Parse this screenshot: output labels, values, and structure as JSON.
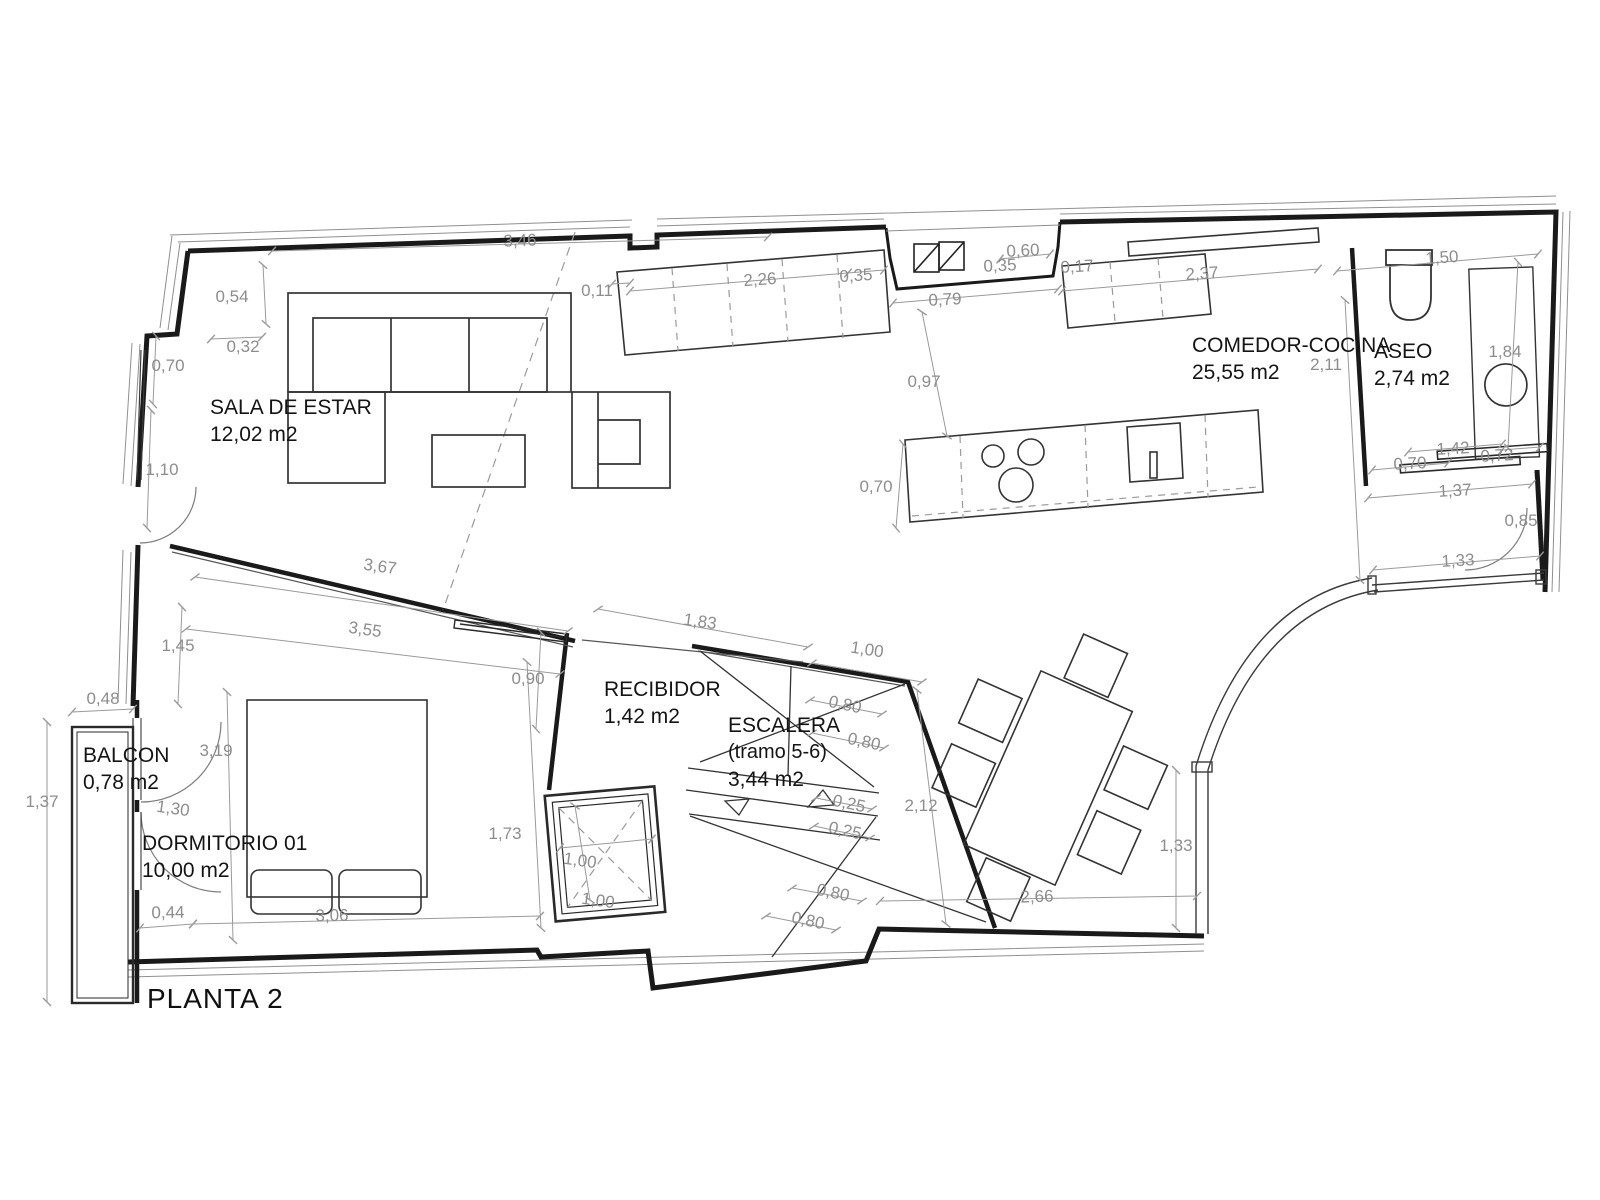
{
  "title": "PLANTA 2",
  "rooms": [
    {
      "id": "sala-de-estar",
      "name": "SALA DE ESTAR",
      "area": "12,02 m2",
      "x": 210,
      "y": 394
    },
    {
      "id": "comedor-cocina",
      "name": "COMEDOR-COCINA",
      "area": "25,55 m2",
      "x": 1192,
      "y": 332
    },
    {
      "id": "aseo",
      "name": "ASEO",
      "area": "2,74 m2",
      "x": 1374,
      "y": 338
    },
    {
      "id": "balcon",
      "name": "BALCON",
      "area": "0,78 m2",
      "x": 83,
      "y": 742
    },
    {
      "id": "dormitorio-01",
      "name": "DORMITORIO 01",
      "area": "10,00 m2",
      "x": 142,
      "y": 830
    },
    {
      "id": "recibidor",
      "name": "RECIBIDOR",
      "area": "1,42 m2",
      "x": 604,
      "y": 676
    },
    {
      "id": "escalera",
      "name": "ESCALERA",
      "sub": "(tramo 5-6)",
      "area": "3,44 m2",
      "x": 728,
      "y": 712
    }
  ],
  "dimensions": [
    {
      "v": "3,46",
      "x": 520,
      "y": 241,
      "r": -2
    },
    {
      "v": "0,54",
      "x": 232,
      "y": 297,
      "r": 0
    },
    {
      "v": "0,32",
      "x": 243,
      "y": 347,
      "r": 0
    },
    {
      "v": "0,70",
      "x": 168,
      "y": 366,
      "r": 0
    },
    {
      "v": "1,10",
      "x": 162,
      "y": 470,
      "r": 0
    },
    {
      "v": "0,11",
      "x": 597,
      "y": 291,
      "r": 0
    },
    {
      "v": "2,26",
      "x": 760,
      "y": 280,
      "r": -4
    },
    {
      "v": "0,35",
      "x": 856,
      "y": 276,
      "r": -4
    },
    {
      "v": "0,79",
      "x": 945,
      "y": 300,
      "r": -3
    },
    {
      "v": "0,60",
      "x": 1023,
      "y": 251,
      "r": -3
    },
    {
      "v": "0,35",
      "x": 1000,
      "y": 266,
      "r": -3
    },
    {
      "v": "0,17",
      "x": 1077,
      "y": 267,
      "r": -3
    },
    {
      "v": "2,37",
      "x": 1202,
      "y": 274,
      "r": -4
    },
    {
      "v": "1,50",
      "x": 1442,
      "y": 258,
      "r": -4
    },
    {
      "v": "0,97",
      "x": 924,
      "y": 382,
      "r": 0
    },
    {
      "v": "2,11",
      "x": 1326,
      "y": 365,
      "r": 0
    },
    {
      "v": "1,84",
      "x": 1505,
      "y": 352,
      "r": 0
    },
    {
      "v": "0,70",
      "x": 876,
      "y": 487,
      "r": 0
    },
    {
      "v": "1,42",
      "x": 1453,
      "y": 449,
      "r": -3
    },
    {
      "v": "0,72",
      "x": 1497,
      "y": 456,
      "r": -3
    },
    {
      "v": "0,70",
      "x": 1410,
      "y": 464,
      "r": -3
    },
    {
      "v": "1,37",
      "x": 1455,
      "y": 491,
      "r": -3
    },
    {
      "v": "0,85",
      "x": 1521,
      "y": 521,
      "r": 0
    },
    {
      "v": "1,33",
      "x": 1458,
      "y": 561,
      "r": -3
    },
    {
      "v": "3,67",
      "x": 380,
      "y": 567,
      "r": 8
    },
    {
      "v": "3,55",
      "x": 365,
      "y": 630,
      "r": 8
    },
    {
      "v": "1,45",
      "x": 178,
      "y": 646,
      "r": 0
    },
    {
      "v": "0,90",
      "x": 528,
      "y": 679,
      "r": 0
    },
    {
      "v": "1,83",
      "x": 700,
      "y": 622,
      "r": 8
    },
    {
      "v": "1,00",
      "x": 867,
      "y": 650,
      "r": 9
    },
    {
      "v": "0,48",
      "x": 103,
      "y": 699,
      "r": 0
    },
    {
      "v": "3,19",
      "x": 216,
      "y": 751,
      "r": 0
    },
    {
      "v": "0,80",
      "x": 845,
      "y": 705,
      "r": 12
    },
    {
      "v": "0,80",
      "x": 864,
      "y": 742,
      "r": 12
    },
    {
      "v": "1,37",
      "x": 42,
      "y": 802,
      "r": 0
    },
    {
      "v": "1,30",
      "x": 173,
      "y": 809,
      "r": 8
    },
    {
      "v": "0,25",
      "x": 849,
      "y": 804,
      "r": 12
    },
    {
      "v": "0,25",
      "x": 845,
      "y": 831,
      "r": 12
    },
    {
      "v": "2,12",
      "x": 921,
      "y": 806,
      "r": 0
    },
    {
      "v": "1,73",
      "x": 505,
      "y": 834,
      "r": 0
    },
    {
      "v": "1,00",
      "x": 580,
      "y": 861,
      "r": 8
    },
    {
      "v": "1,00",
      "x": 598,
      "y": 901,
      "r": 8
    },
    {
      "v": "0,80",
      "x": 833,
      "y": 893,
      "r": 12
    },
    {
      "v": "0,80",
      "x": 808,
      "y": 921,
      "r": 12
    },
    {
      "v": "1,33",
      "x": 1176,
      "y": 846,
      "r": 0
    },
    {
      "v": "2,66",
      "x": 1037,
      "y": 897,
      "r": -2
    },
    {
      "v": "0,44",
      "x": 168,
      "y": 913,
      "r": -1
    },
    {
      "v": "3,06",
      "x": 332,
      "y": 916,
      "r": -1
    }
  ]
}
